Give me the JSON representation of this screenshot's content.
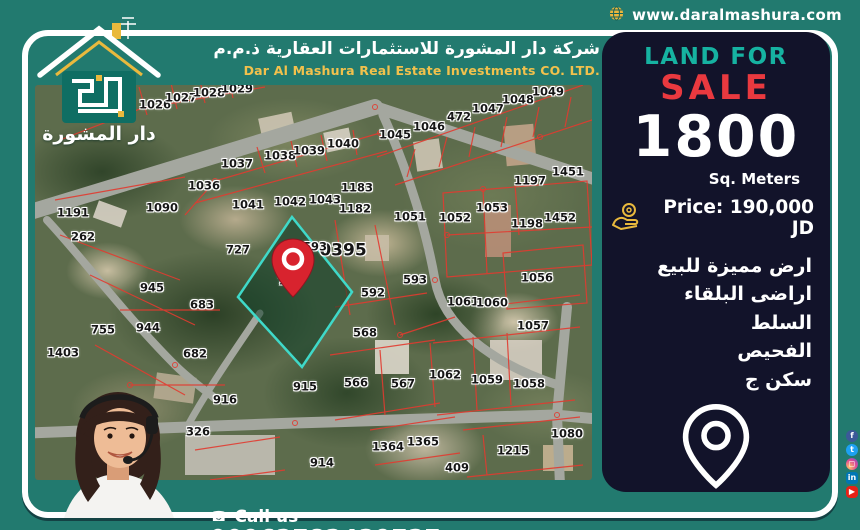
{
  "topbar": {
    "website": "www.daralmashura.com"
  },
  "logo": {
    "text": "دار المشورة"
  },
  "header": {
    "company_ar": "شركة دار المشورة للاستثمارات العقارية ذ.م.م",
    "company_en": "Dar Al Mashura Real Estate Investments CO. LTD."
  },
  "panel": {
    "land_for": "LAND FOR",
    "sale": "SALE",
    "area_value": "1800",
    "area_unit": "Sq. Meters",
    "price_label": "Price: 190,000 JD",
    "desc_lines": [
      "ارض مميزة للبيع",
      "اراضى البلقاء السلط",
      "الفحيص",
      "سكن ج"
    ],
    "location_name": "الفحيص"
  },
  "contact": {
    "call_us": "Call us",
    "phone": "00962782439737"
  },
  "social": [
    {
      "name": "facebook",
      "glyph": "f",
      "color": "#3b5998"
    },
    {
      "name": "twitter",
      "glyph": "t",
      "color": "#1da1f2"
    },
    {
      "name": "instagram",
      "glyph": "◻",
      "color": ""
    },
    {
      "name": "linkedin",
      "glyph": "in",
      "color": "#0077b5"
    },
    {
      "name": "youtube",
      "glyph": "▶",
      "color": "#e62117"
    }
  ],
  "colors": {
    "background_teal": "#227a6f",
    "panel_navy": "#12132a",
    "accent_teal": "#16b2a1",
    "sale_red": "#e9393f",
    "brand_yellow": "#f2c14c",
    "parcel_line_red": "#e23b30",
    "highlight_cyan": "#3fd9c9",
    "pin_red": "#d8232e"
  },
  "map": {
    "block_number": "0395",
    "highlighted_parcel": "724",
    "parcels": [
      {
        "n": "1026",
        "x": 120,
        "y": 20
      },
      {
        "n": "1027",
        "x": 146,
        "y": 13
      },
      {
        "n": "1028",
        "x": 174,
        "y": 8
      },
      {
        "n": "1029",
        "x": 202,
        "y": 4
      },
      {
        "n": "1036",
        "x": 169,
        "y": 101
      },
      {
        "n": "1037",
        "x": 202,
        "y": 79
      },
      {
        "n": "1038",
        "x": 245,
        "y": 71
      },
      {
        "n": "1039",
        "x": 274,
        "y": 66
      },
      {
        "n": "1040",
        "x": 308,
        "y": 59
      },
      {
        "n": "1045",
        "x": 360,
        "y": 50
      },
      {
        "n": "1046",
        "x": 394,
        "y": 42
      },
      {
        "n": "472",
        "x": 424,
        "y": 32
      },
      {
        "n": "1047",
        "x": 453,
        "y": 24
      },
      {
        "n": "1048",
        "x": 483,
        "y": 15
      },
      {
        "n": "1049",
        "x": 513,
        "y": 7
      },
      {
        "n": "1183",
        "x": 322,
        "y": 103
      },
      {
        "n": "1197",
        "x": 495,
        "y": 96
      },
      {
        "n": "1451",
        "x": 533,
        "y": 87
      },
      {
        "n": "1191",
        "x": 38,
        "y": 128
      },
      {
        "n": "1090",
        "x": 127,
        "y": 123
      },
      {
        "n": "262",
        "x": 48,
        "y": 152
      },
      {
        "n": "945",
        "x": 117,
        "y": 203
      },
      {
        "n": "683",
        "x": 167,
        "y": 220
      },
      {
        "n": "727",
        "x": 203,
        "y": 165
      },
      {
        "n": "1041",
        "x": 213,
        "y": 120
      },
      {
        "n": "1042",
        "x": 255,
        "y": 117
      },
      {
        "n": "1043",
        "x": 290,
        "y": 115
      },
      {
        "n": "1182",
        "x": 320,
        "y": 124
      },
      {
        "n": "1051",
        "x": 375,
        "y": 132
      },
      {
        "n": "593",
        "x": 280,
        "y": 162
      },
      {
        "n": "724",
        "x": 255,
        "y": 196
      },
      {
        "n": "593",
        "x": 380,
        "y": 195
      },
      {
        "n": "592",
        "x": 338,
        "y": 208
      },
      {
        "n": "1052",
        "x": 420,
        "y": 133
      },
      {
        "n": "1053",
        "x": 457,
        "y": 123
      },
      {
        "n": "1198",
        "x": 492,
        "y": 139
      },
      {
        "n": "1452",
        "x": 525,
        "y": 133
      },
      {
        "n": "1056",
        "x": 502,
        "y": 193
      },
      {
        "n": "1061",
        "x": 428,
        "y": 217
      },
      {
        "n": "1060",
        "x": 457,
        "y": 218
      },
      {
        "n": "755",
        "x": 68,
        "y": 245
      },
      {
        "n": "944",
        "x": 113,
        "y": 243
      },
      {
        "n": "1403",
        "x": 28,
        "y": 268
      },
      {
        "n": "682",
        "x": 160,
        "y": 269
      },
      {
        "n": "916",
        "x": 190,
        "y": 315
      },
      {
        "n": "568",
        "x": 330,
        "y": 248
      },
      {
        "n": "915",
        "x": 270,
        "y": 302
      },
      {
        "n": "566",
        "x": 321,
        "y": 298
      },
      {
        "n": "567",
        "x": 368,
        "y": 299
      },
      {
        "n": "1364",
        "x": 353,
        "y": 362
      },
      {
        "n": "1365",
        "x": 388,
        "y": 357
      },
      {
        "n": "914",
        "x": 287,
        "y": 378
      },
      {
        "n": "1057",
        "x": 498,
        "y": 241
      },
      {
        "n": "1062",
        "x": 410,
        "y": 290
      },
      {
        "n": "1059",
        "x": 452,
        "y": 295
      },
      {
        "n": "1058",
        "x": 494,
        "y": 299
      },
      {
        "n": "1215",
        "x": 478,
        "y": 366
      },
      {
        "n": "409",
        "x": 422,
        "y": 383
      },
      {
        "n": "1080",
        "x": 532,
        "y": 349
      },
      {
        "n": "327",
        "x": 97,
        "y": 347
      },
      {
        "n": "326",
        "x": 163,
        "y": 347
      }
    ]
  }
}
